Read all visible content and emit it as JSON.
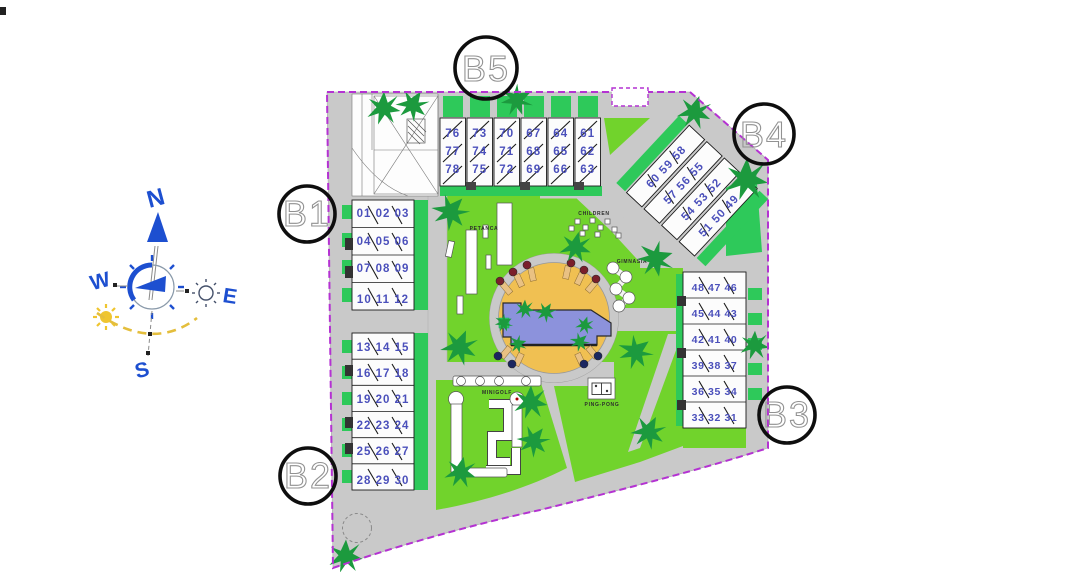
{
  "compass": {
    "n": "N",
    "e": "E",
    "s": "S",
    "w": "W"
  },
  "blocks": {
    "b1": {
      "label": "B1",
      "rows": [
        "01 02 03",
        "04 05 06",
        "07 08 09",
        "10 11 12"
      ]
    },
    "b2": {
      "label": "B2",
      "rows": [
        "13 14 15",
        "16 17 18",
        "19 20 21",
        "22 23 24",
        "25 26 27",
        "28 29 30"
      ]
    },
    "b3": {
      "label": "B3",
      "rows": [
        "48 47 46",
        "45 44 43",
        "42 41 40",
        "39 38 37",
        "36 35 34",
        "33 32 31"
      ]
    },
    "b4": {
      "label": "B4",
      "rows": [
        "60 59 58",
        "57 56 55",
        "54 53 52",
        "51 50 49"
      ]
    },
    "b5": {
      "label": "B5",
      "columns": [
        [
          "76",
          "77",
          "78"
        ],
        [
          "73",
          "74",
          "75"
        ],
        [
          "70",
          "71",
          "72"
        ],
        [
          "67",
          "68",
          "69"
        ],
        [
          "64",
          "65",
          "66"
        ],
        [
          "61",
          "62",
          "63"
        ]
      ]
    }
  },
  "amenities": {
    "petanca": "PETANCA",
    "children": "CHILDREN",
    "gimnasia": "GIMNASIA",
    "minigolf": "MINIGOLF",
    "ping_pong": "PING-PONG"
  },
  "colors": {
    "lawn": "#71D32C",
    "garden_strip": "#2EC95A",
    "road": "#C9C9C9",
    "sand": "#F0C052",
    "pool": "#8C92DC",
    "boundary": "#B432D2",
    "unit_number": "#4B50BB",
    "tree": "#1C9A3E",
    "compass_blue": "#1D4FD0",
    "sun_yellow": "#EFC52F"
  }
}
